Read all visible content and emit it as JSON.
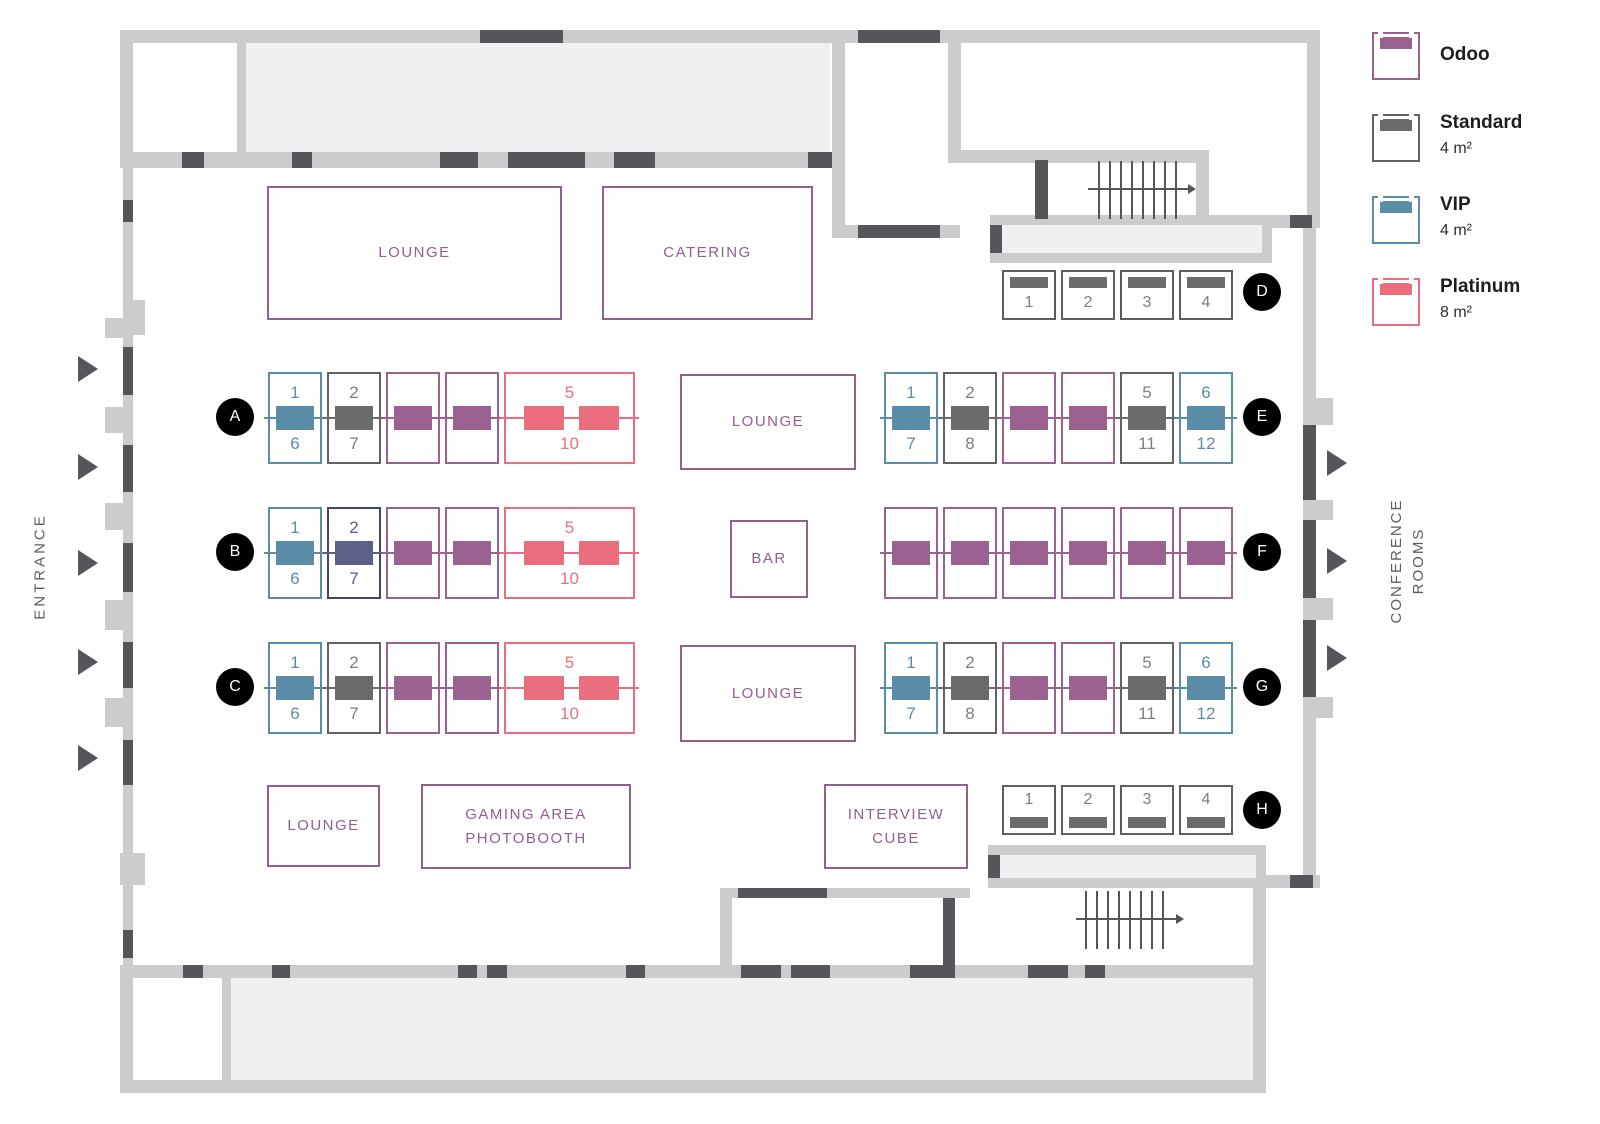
{
  "colors": {
    "wall": "#cbcccd",
    "wall_door_dark": "#55565a",
    "room_fill": "#eef0f2",
    "area_outline": "#91608c",
    "marker_bg": "#000000",
    "marker_text": "#ffffff",
    "side_label_text": "#5d5e60",
    "odoo": "#9a6191",
    "standard": "#6a6b6d",
    "vip": "#5b8ca8",
    "platinum": "#ea6e7d",
    "selected_fill": "#5c5f87",
    "selected_border": "#43466a"
  },
  "legend": {
    "items": [
      {
        "category": "odoo",
        "label": "Odoo",
        "size": "",
        "color": "#9a6191"
      },
      {
        "category": "standard",
        "label": "Standard",
        "size": "4 m²",
        "color": "#6a6b6d"
      },
      {
        "category": "vip",
        "label": "VIP",
        "size": "4 m²",
        "color": "#5b8ca8"
      },
      {
        "category": "platinum",
        "label": "Platinum",
        "size": "8 m²",
        "color": "#ea6e7d"
      }
    ]
  },
  "labels": {
    "entrance": "ENTRANCE",
    "conference_rooms_line1": "CONFERENCE",
    "conference_rooms_line2": "ROOMS"
  },
  "areas": [
    {
      "id": "lounge-top",
      "lines": [
        "LOUNGE"
      ]
    },
    {
      "id": "catering",
      "lines": [
        "CATERING"
      ]
    },
    {
      "id": "lounge-center",
      "lines": [
        "LOUNGE"
      ]
    },
    {
      "id": "bar",
      "lines": [
        "BAR"
      ]
    },
    {
      "id": "lounge-center-south",
      "lines": [
        "LOUNGE"
      ]
    },
    {
      "id": "lounge-south-west",
      "lines": [
        "LOUNGE"
      ]
    },
    {
      "id": "gaming-area",
      "lines": [
        "GAMING AREA",
        "PHOTOBOOTH"
      ]
    },
    {
      "id": "interview-cube",
      "lines": [
        "INTERVIEW",
        "CUBE"
      ]
    }
  ],
  "rows": [
    {
      "id": "A",
      "marker": "A",
      "booth_style": "double",
      "booths": [
        {
          "type": "vip",
          "top": "1",
          "bottom": "6"
        },
        {
          "type": "standard",
          "top": "2",
          "bottom": "7"
        },
        {
          "type": "odoo"
        },
        {
          "type": "odoo"
        },
        {
          "type": "platinum",
          "top": "5",
          "bottom": "10"
        }
      ]
    },
    {
      "id": "B",
      "marker": "B",
      "booth_style": "double",
      "booths": [
        {
          "type": "vip",
          "top": "1",
          "bottom": "6"
        },
        {
          "type": "selected",
          "top": "2",
          "bottom": "7"
        },
        {
          "type": "odoo"
        },
        {
          "type": "odoo"
        },
        {
          "type": "platinum",
          "top": "5",
          "bottom": "10"
        }
      ]
    },
    {
      "id": "C",
      "marker": "C",
      "booth_style": "double",
      "booths": [
        {
          "type": "vip",
          "top": "1",
          "bottom": "6"
        },
        {
          "type": "standard",
          "top": "2",
          "bottom": "7"
        },
        {
          "type": "odoo"
        },
        {
          "type": "odoo"
        },
        {
          "type": "platinum",
          "top": "5",
          "bottom": "10"
        }
      ]
    },
    {
      "id": "D",
      "marker": "D",
      "booth_style": "single",
      "bar_position": "top",
      "booths": [
        {
          "type": "standard",
          "number": "1"
        },
        {
          "type": "standard",
          "number": "2"
        },
        {
          "type": "standard",
          "number": "3"
        },
        {
          "type": "standard",
          "number": "4"
        }
      ]
    },
    {
      "id": "E",
      "marker": "E",
      "booth_style": "double",
      "booths": [
        {
          "type": "vip",
          "top": "1",
          "bottom": "7"
        },
        {
          "type": "standard",
          "top": "2",
          "bottom": "8"
        },
        {
          "type": "odoo"
        },
        {
          "type": "odoo"
        },
        {
          "type": "standard",
          "top": "5",
          "bottom": "11"
        },
        {
          "type": "vip",
          "top": "6",
          "bottom": "12"
        }
      ]
    },
    {
      "id": "F",
      "marker": "F",
      "booth_style": "double",
      "booths": [
        {
          "type": "odoo"
        },
        {
          "type": "odoo"
        },
        {
          "type": "odoo"
        },
        {
          "type": "odoo"
        },
        {
          "type": "odoo"
        },
        {
          "type": "odoo"
        }
      ]
    },
    {
      "id": "G",
      "marker": "G",
      "booth_style": "double",
      "booths": [
        {
          "type": "vip",
          "top": "1",
          "bottom": "7"
        },
        {
          "type": "standard",
          "top": "2",
          "bottom": "8"
        },
        {
          "type": "odoo"
        },
        {
          "type": "odoo"
        },
        {
          "type": "standard",
          "top": "5",
          "bottom": "11"
        },
        {
          "type": "vip",
          "top": "6",
          "bottom": "12"
        }
      ]
    },
    {
      "id": "H",
      "marker": "H",
      "booth_style": "single",
      "bar_position": "bottom",
      "booths": [
        {
          "type": "standard",
          "number": "1"
        },
        {
          "type": "standard",
          "number": "2"
        },
        {
          "type": "standard",
          "number": "3"
        },
        {
          "type": "standard",
          "number": "4"
        }
      ]
    }
  ]
}
